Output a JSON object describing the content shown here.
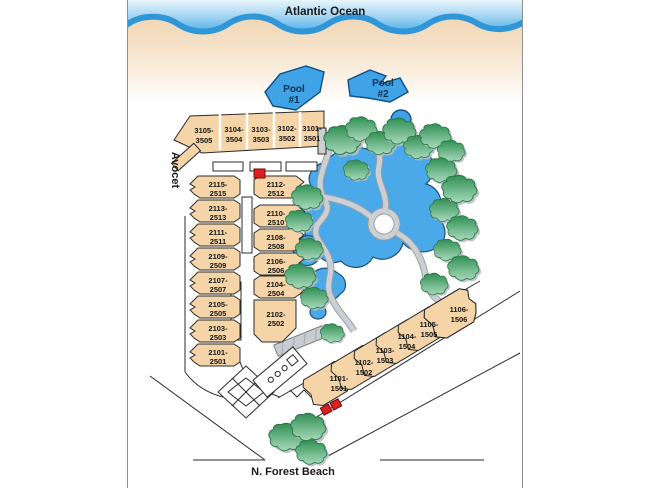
{
  "map": {
    "ocean_label": "Atlantic Ocean",
    "streets": {
      "left": "Avocet",
      "bottom": "N. Forest Beach"
    },
    "pools": [
      {
        "line1": "Pool",
        "line2": "#1"
      },
      {
        "line1": "Pool",
        "line2": "#2"
      }
    ],
    "buildings": {
      "top_row": [
        {
          "top": "3105-",
          "bottom": "3505"
        },
        {
          "top": "3104-",
          "bottom": "3504"
        },
        {
          "top": "3103-",
          "bottom": "3503"
        },
        {
          "top": "3102-",
          "bottom": "3502"
        },
        {
          "top": "3101-",
          "bottom": "3501"
        }
      ],
      "left_column": [
        {
          "top": "2115-",
          "bottom": "2515"
        },
        {
          "top": "2113-",
          "bottom": "2513"
        },
        {
          "top": "2111-",
          "bottom": "2511"
        },
        {
          "top": "2109-",
          "bottom": "2509"
        },
        {
          "top": "2107-",
          "bottom": "2507"
        },
        {
          "top": "2105-",
          "bottom": "2505"
        },
        {
          "top": "2103-",
          "bottom": "2503"
        },
        {
          "top": "2101-",
          "bottom": "2501"
        }
      ],
      "mid_column": [
        {
          "top": "2112-",
          "bottom": "2512"
        },
        {
          "top": "2110-",
          "bottom": "2510"
        },
        {
          "top": "2108-",
          "bottom": "2508"
        },
        {
          "top": "2106-",
          "bottom": "2506"
        },
        {
          "top": "2104-",
          "bottom": "2504"
        },
        {
          "top": "2102-",
          "bottom": "2502"
        }
      ],
      "beach_row": [
        {
          "top": "1101-",
          "bottom": "1501"
        },
        {
          "top": "1102-",
          "bottom": "1502"
        },
        {
          "top": "1103-",
          "bottom": "1503"
        },
        {
          "top": "1104-",
          "bottom": "1504"
        },
        {
          "top": "1105-",
          "bottom": "1505"
        },
        {
          "top": "1106-",
          "bottom": "1506"
        }
      ]
    },
    "colors": {
      "ocean_light": "#d8edfa",
      "ocean_deep": "#5ab4e9",
      "wave": "#2f96d8",
      "sand": "#f3dcc0",
      "building": "#f5d5a8",
      "water": "#49a9e9",
      "tree_dark": "#2f8f52",
      "tree_light": "#a8dabb",
      "path": "#ccd0d4",
      "marker_red": "#e02020"
    }
  }
}
